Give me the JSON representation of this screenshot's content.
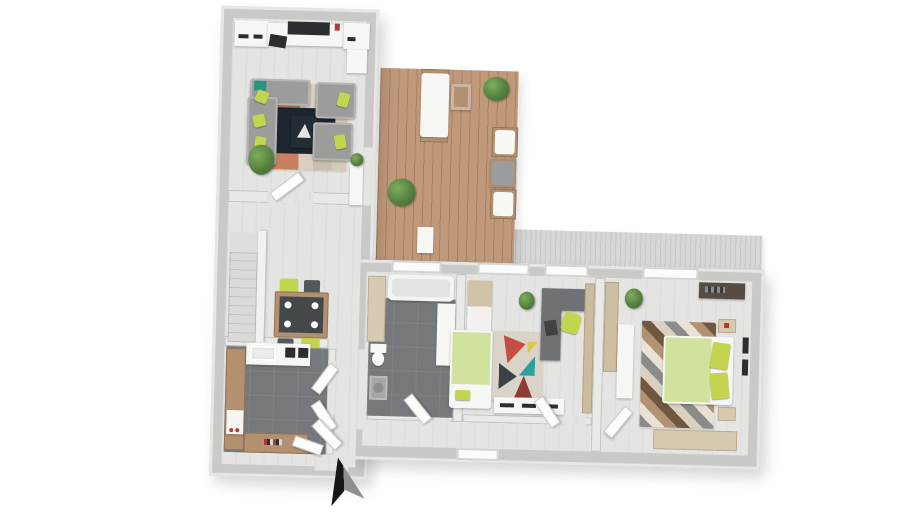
{
  "meta": {
    "type": "3d-floor-plan-top-view-render",
    "visible_text": "",
    "layout_shape": "L-shaped apartment, left wing vertical, right wing horizontal, wooden deck in the inner corner, hatched roof band above right wing",
    "compass": "black-and-gray entrance arrow pointing up, below entry at bottom of left wing"
  },
  "palette": {
    "background": "#ffffff",
    "wall": "#c9c9c8",
    "wall_edge": "#e6e6e5",
    "floor_light": "#e4e4e3",
    "tile_dark": "#75797b",
    "deck_wood": "#c0997b",
    "roof_gray": "#d6d7d6",
    "sofa_gray": "#9c9c9a",
    "accent_lime": "#c3d44f",
    "accent_teal": "#2a9384",
    "rug_navy": "#1d2630",
    "rug_terracotta": "#c8805f",
    "rug_beige": "#d8cfc0",
    "bed_green": "#d0e29b",
    "desk_gray": "#6f7274",
    "counter_wood": "#b39070",
    "cabinet_cream": "#d6cbb2",
    "rug_red": "#c24d45",
    "rug_teal": "#2da09c",
    "rug_charcoal": "#3c4148",
    "chevron_brown": "#b29371",
    "arrow_black": "#161616"
  },
  "scene": {
    "rooms": [
      {
        "name": "living-room",
        "position": "top of left wing",
        "furniture": [
          "media-shelves",
          "tv",
          "laptop",
          "sideboard",
          "gray-corner-sofa with lime pillows and teal throw",
          "two-gray-armchairs with lime pillows",
          "terracotta-area-rug",
          "navy-rug",
          "dark-coffee-table with white sail motif",
          "potted-plant",
          "deck-sideboard with plant"
        ]
      },
      {
        "name": "hall-dining",
        "position": "middle of left wing",
        "furniture": [
          "staircase with banister",
          "dining-table dark top wood frame, four white plates",
          "two-lime-chairs",
          "two-dark-chairs",
          "open-door to living room"
        ]
      },
      {
        "name": "kitchen",
        "position": "bottom of left wing",
        "floor": "dark tile",
        "furniture": [
          "u-shaped-counter wood",
          "white-sink-counter",
          "dark-cooktop",
          "white-appliance with red knobs",
          "open-double-doors to corridor"
        ]
      },
      {
        "name": "entry",
        "position": "bottom of left wing",
        "furniture": [
          "open-entrance-doors",
          "entrance-arrow"
        ]
      },
      {
        "name": "bathroom",
        "position": "right wing, left room",
        "floor": "dark tile",
        "furniture": [
          "bathtub",
          "toilet",
          "washing-machine",
          "tall-cream-cabinet",
          "white-vanity",
          "window"
        ]
      },
      {
        "name": "bedroom-office",
        "position": "right wing, middle room",
        "furniture": [
          "single-bed green bedding",
          "geometric-rug red teal charcoal",
          "two-tone-wardrobe",
          "drawer-bench",
          "l-shaped-desk dark gray",
          "lime-office-chair",
          "dark-chair",
          "potted-plant",
          "windows"
        ]
      },
      {
        "name": "master-bedroom",
        "position": "right wing, right room",
        "furniture": [
          "double-bed green bedding, two lime pillows",
          "chevron-rug gray cream brown",
          "wood-wardrobe",
          "white-dresser",
          "two-nightstands",
          "dark-vanity-desk",
          "wall-frames",
          "bench",
          "potted-plant",
          "windows"
        ]
      }
    ],
    "outdoor": {
      "name": "deck-terrace",
      "position": "inner corner, top middle",
      "furniture": [
        "sun-lounger",
        "wood-side-table",
        "two-white-armchairs",
        "gray-coffee-table",
        "two-potted-plants",
        "white-storage-box"
      ]
    }
  }
}
